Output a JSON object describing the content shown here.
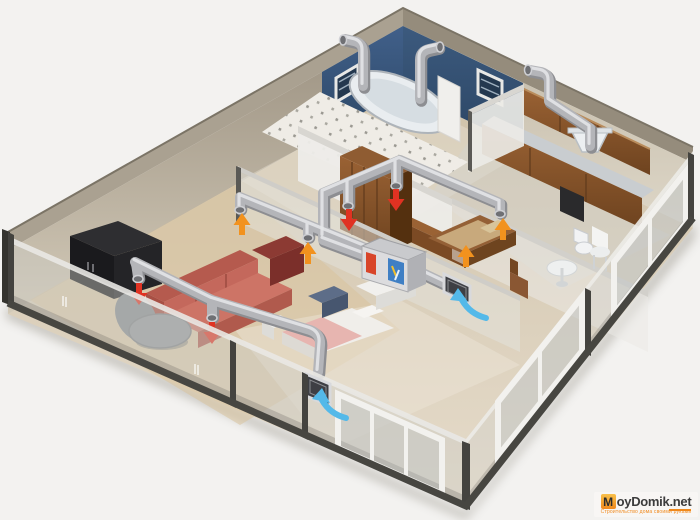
{
  "watermark": {
    "initial": "M",
    "name_rest": "oyDomik",
    "tld": ".net",
    "tagline": "Строительство дома своими руками"
  },
  "colors": {
    "background": "#f3f2f0",
    "wall_top": "#a59c8c",
    "wall_beige": "#b3a894",
    "wall_beige_light": "#d6cdbc",
    "wall_blue": "#3c5878",
    "wall_blue_dark": "#2d4664",
    "wall_white": "#ecebe8",
    "floor": "#d9cdb6",
    "floor_wood": "#d8c19c",
    "tile": "#efece6",
    "glass": "#c9c8c4",
    "edge_dark": "#44433f",
    "duct": "#b4b5b9",
    "duct_shade": "#8d8e92",
    "duct_light": "#e6e7ea",
    "arrow_supply": "#e03222",
    "arrow_extract": "#f2921e",
    "arrow_intake": "#54b9e9",
    "sofa": "#c2685c",
    "sofa_dark": "#9d4a40",
    "armchair": "#7e332e",
    "wood": "#8a5733",
    "wood_dark": "#63401f",
    "black_furniture": "#1c1c1f",
    "white_furniture": "#f1f0ee",
    "unit_body": "#d8d8da",
    "watermark_orange": "#f0891c",
    "watermark_text": "#3c3c3c"
  },
  "scene": {
    "type": "3d-cutaway-illustration",
    "subject": "apartment supply-and-exhaust ventilation system with heat recovery unit",
    "rooms": [
      "living-room",
      "bedroom",
      "hallway",
      "bathroom",
      "wc",
      "kitchen",
      "dining-room"
    ],
    "equipment": [
      "round-air-ducts",
      "heat-recovery-unit",
      "ceiling-supply-outlets",
      "extract-inlets",
      "outdoor-intake-grilles",
      "kitchen-hood",
      "exhaust-pipes-over-bathroom-wall"
    ],
    "airflow_arrows": {
      "supply_red": {
        "count": 4,
        "direction": "down"
      },
      "extract_orange": {
        "count": 4,
        "direction": "up"
      },
      "intake_blue": {
        "count": 2,
        "direction": "into-wall-grille"
      }
    },
    "furniture": [
      "corner-sofa",
      "dark-red-armchair",
      "gray-swivel-chair",
      "tv-cabinet",
      "bed",
      "wardrobe",
      "bathtub",
      "kitchen-cabinets",
      "dining-chair",
      "round-table",
      "toilet",
      "wooden-bed"
    ]
  }
}
